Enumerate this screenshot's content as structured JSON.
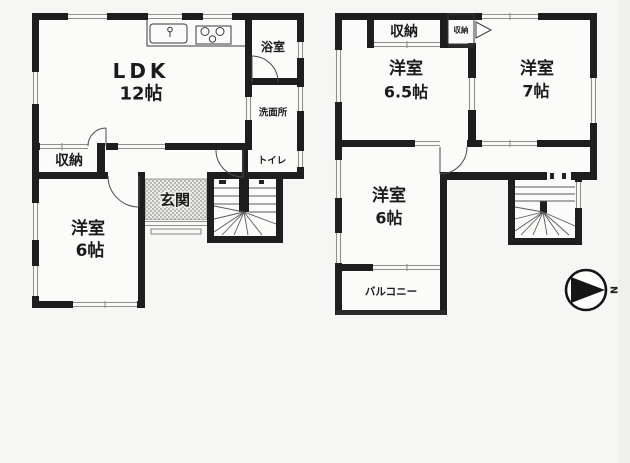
{
  "colors": {
    "wall": "#1e1e1e",
    "background": "#f6f6f4"
  },
  "floor1": {
    "rooms": {
      "ldk": {
        "name": "LDK",
        "size": "12帖"
      },
      "bath": {
        "name": "浴室"
      },
      "washroom": {
        "name": "洗面所"
      },
      "toilet": {
        "name": "トイレ"
      },
      "storage": {
        "name": "収納"
      },
      "entrance": {
        "name": "玄関"
      },
      "west_room": {
        "name": "洋室",
        "size": "6帖"
      }
    }
  },
  "floor2": {
    "rooms": {
      "storage_main": {
        "name": "収納"
      },
      "storage_small": {
        "name": "収納"
      },
      "room_65": {
        "name": "洋室",
        "size": "6.5帖"
      },
      "room_7": {
        "name": "洋室",
        "size": "7帖"
      },
      "room_6": {
        "name": "洋室",
        "size": "6帖"
      },
      "balcony": {
        "name": "バルコニー"
      }
    }
  },
  "compass": {
    "north_label": "N"
  }
}
